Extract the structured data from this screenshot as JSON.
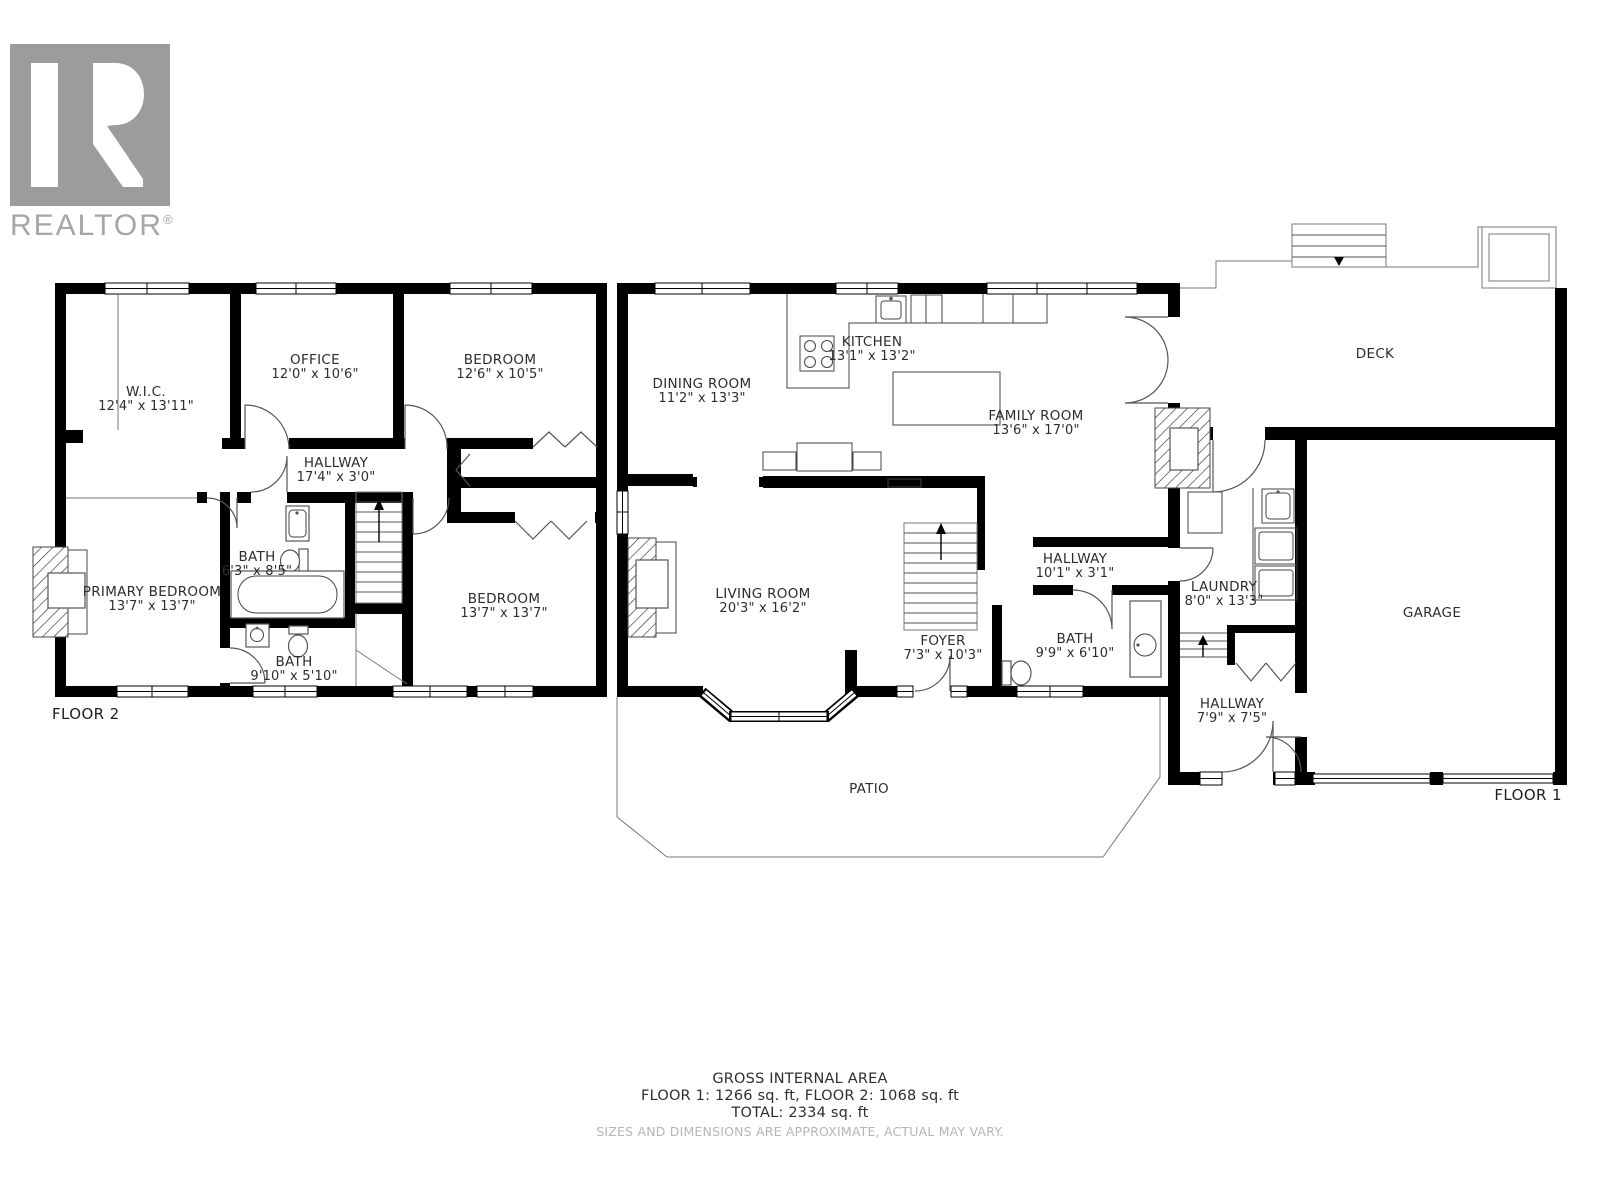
{
  "logo": {
    "brand": "REALTOR",
    "registered": "®"
  },
  "floor2": {
    "label": "FLOOR 2",
    "rooms": {
      "wic": {
        "name": "W.I.C.",
        "dims": "12'4\" x 13'11\""
      },
      "office": {
        "name": "OFFICE",
        "dims": "12'0\" x 10'6\""
      },
      "bedroom_top": {
        "name": "BEDROOM",
        "dims": "12'6\" x 10'5\""
      },
      "hallway": {
        "name": "HALLWAY",
        "dims": "17'4\" x 3'0\""
      },
      "bath_top": {
        "name": "BATH",
        "dims": "6'3\" x 8'5\""
      },
      "primary_bedroom": {
        "name": "PRIMARY BEDROOM",
        "dims": "13'7\" x 13'7\""
      },
      "bath_bottom": {
        "name": "BATH",
        "dims": "9'10\" x 5'10\""
      },
      "bedroom_bottom": {
        "name": "BEDROOM",
        "dims": "13'7\" x 13'7\""
      }
    }
  },
  "floor1": {
    "label": "FLOOR 1",
    "rooms": {
      "dining_room": {
        "name": "DINING ROOM",
        "dims": "11'2\" x 13'3\""
      },
      "kitchen": {
        "name": "KITCHEN",
        "dims": "13'1\" x 13'2\""
      },
      "family_room": {
        "name": "FAMILY ROOM",
        "dims": "13'6\" x 17'0\""
      },
      "deck": {
        "name": "DECK"
      },
      "living_room": {
        "name": "LIVING ROOM",
        "dims": "20'3\" x 16'2\""
      },
      "hallway_main": {
        "name": "HALLWAY",
        "dims": "10'1\" x 3'1\""
      },
      "laundry": {
        "name": "LAUNDRY",
        "dims": "8'0\" x 13'3\""
      },
      "garage": {
        "name": "GARAGE"
      },
      "foyer": {
        "name": "FOYER",
        "dims": "7'3\" x 10'3\""
      },
      "bath": {
        "name": "BATH",
        "dims": "9'9\" x 6'10\""
      },
      "hallway_entry": {
        "name": "HALLWAY",
        "dims": "7'9\" x 7'5\""
      },
      "patio": {
        "name": "PATIO"
      }
    }
  },
  "footer": {
    "title": "GROSS INTERNAL AREA",
    "areas": "FLOOR 1: 1266 sq. ft, FLOOR 2: 1068 sq. ft",
    "total": "TOTAL: 2334 sq. ft",
    "disclaimer": "SIZES AND DIMENSIONS ARE APPROXIMATE, ACTUAL MAY VARY."
  },
  "colors": {
    "wall": "#000000",
    "logo_gray": "#9c9c9c",
    "text": "#2d2d2d",
    "disclaimer_gray": "#b5b5b5"
  }
}
